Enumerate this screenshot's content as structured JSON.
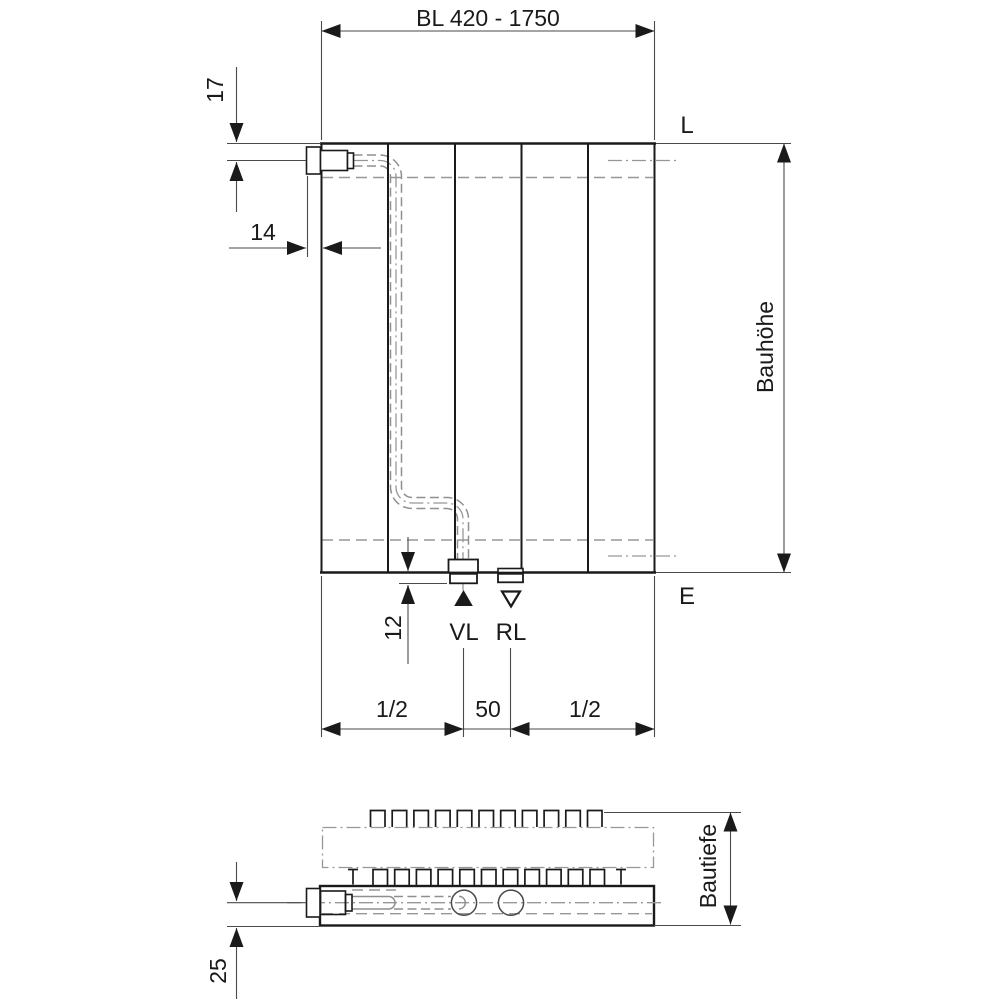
{
  "front_view": {
    "length_dimension": "BL 420 - 1750",
    "top_connection_offset": "17",
    "side_connection_offset": "14",
    "bottom_stub_length": "12",
    "supply_label": "VL",
    "return_label": "RL",
    "top_right_label": "L",
    "bottom_right_label": "E",
    "height_label": "Bauhöhe",
    "bottom_left_span": "1/2",
    "bottom_center_span": "50",
    "bottom_right_span": "1/2"
  },
  "plan_view": {
    "depth_label": "Bautiefe",
    "connection_axis_offset": "25"
  },
  "colors": {
    "outline": "#1a1a1a",
    "dimension_line": "#4a4a4a",
    "hidden_line": "#979797",
    "background": "#ffffff"
  }
}
